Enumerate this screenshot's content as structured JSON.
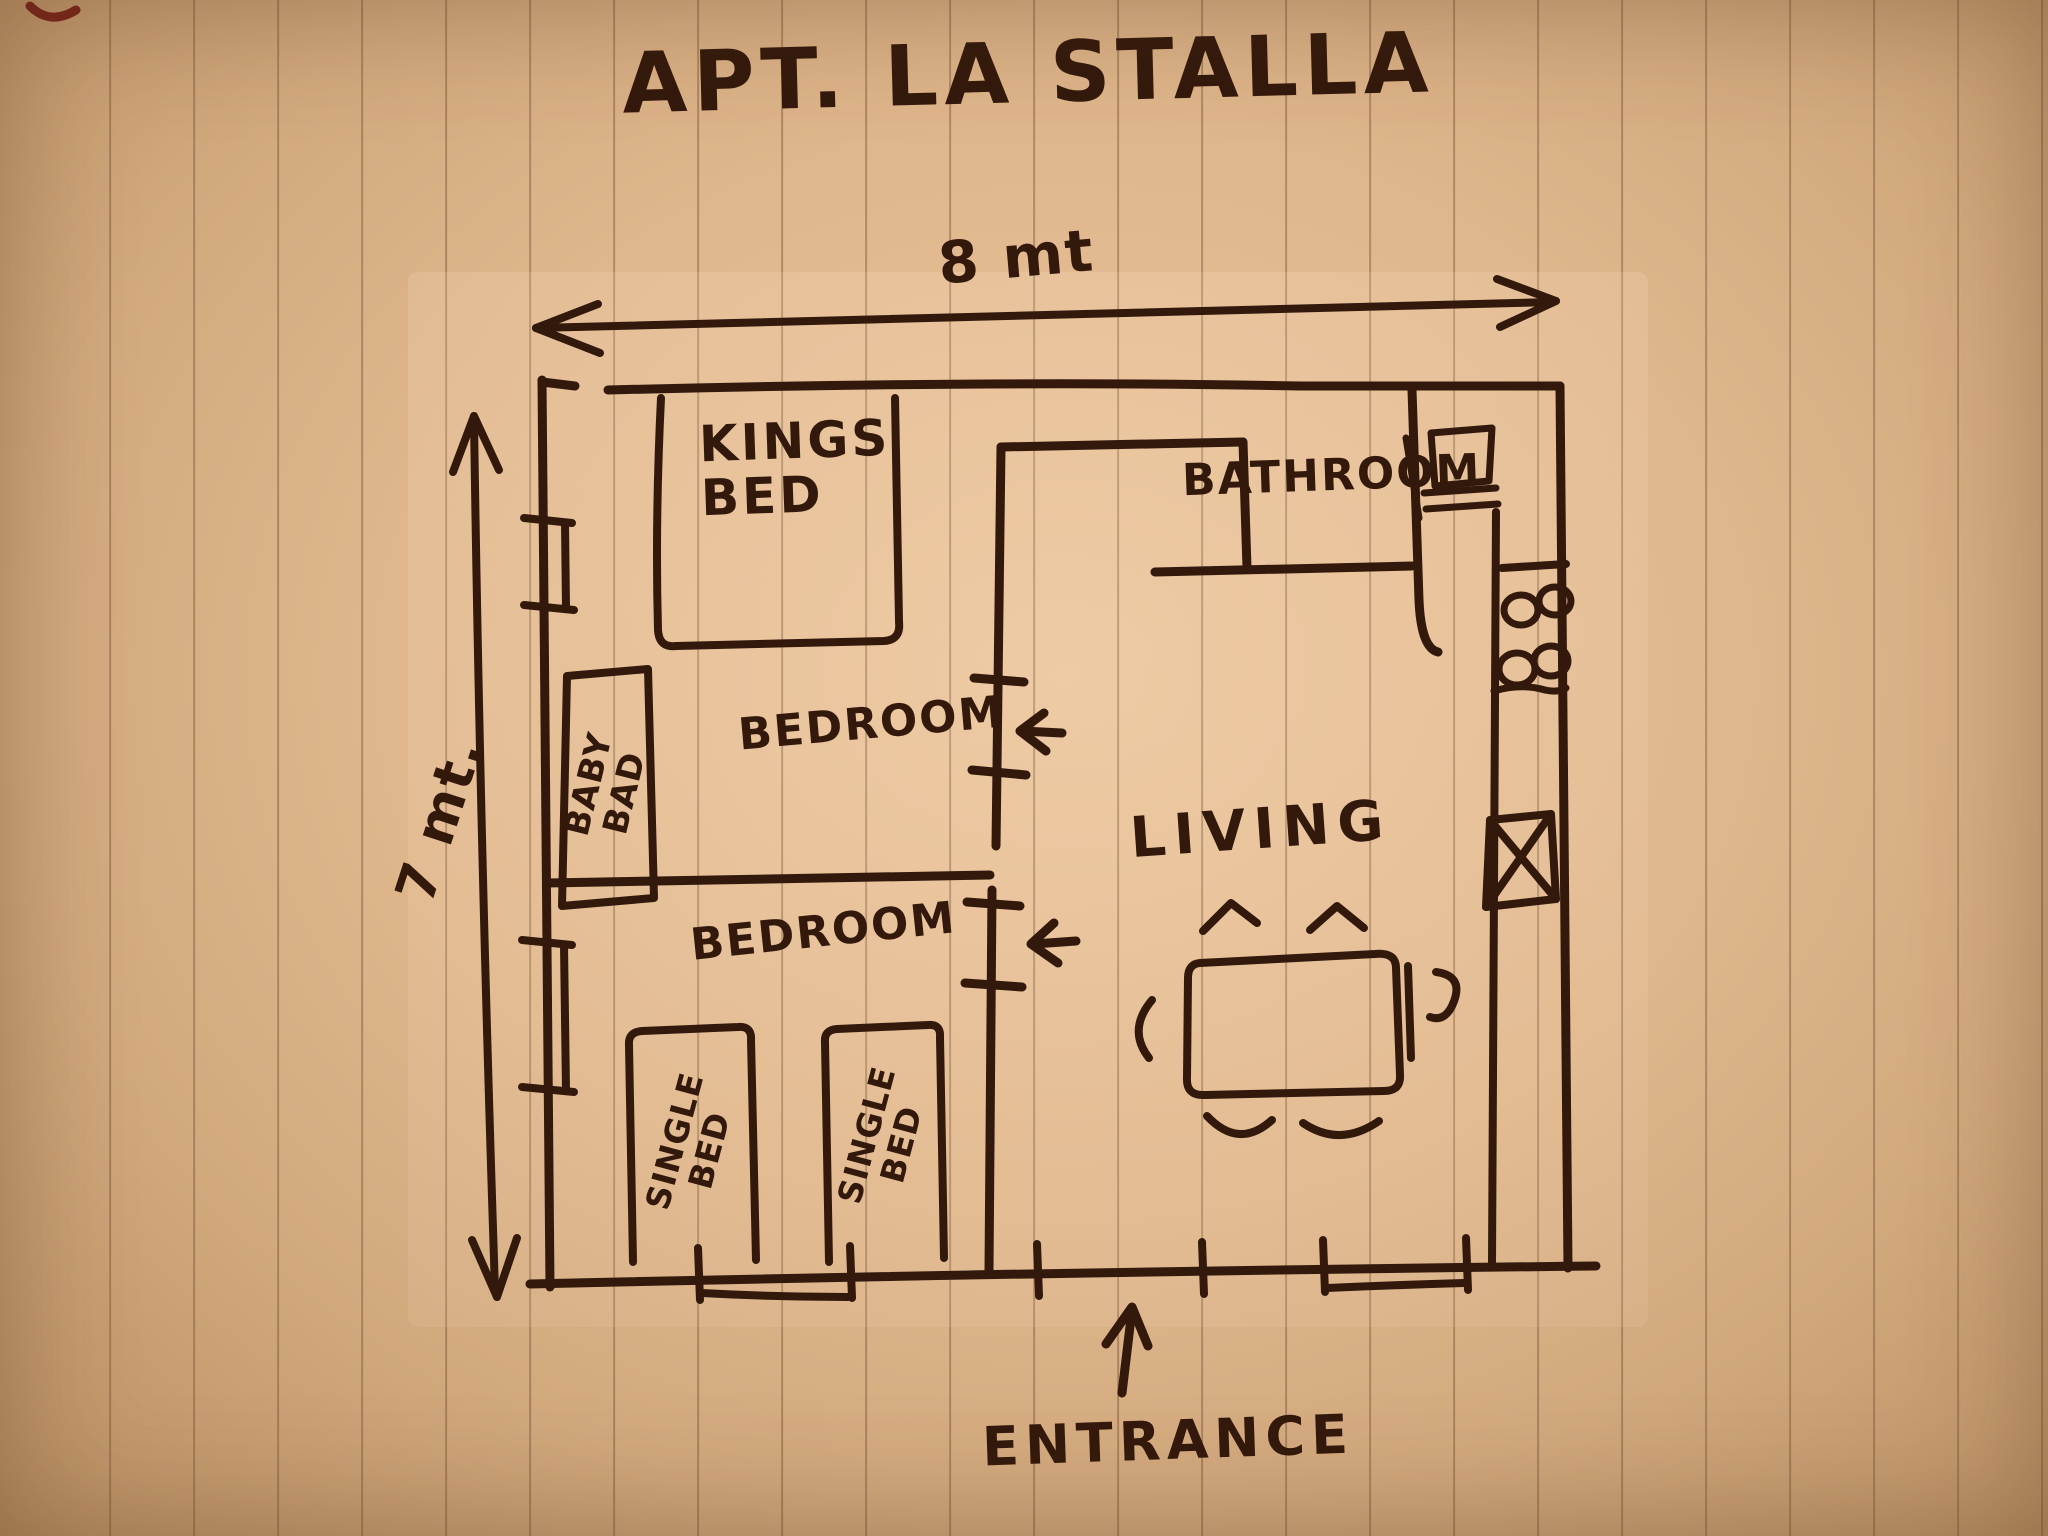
{
  "page": {
    "title": "APT. LA STALLA"
  },
  "dimensions": {
    "width_label": "8 mt",
    "height_label": "7 mt."
  },
  "rooms": {
    "kings_bed": {
      "line1": "KINGS",
      "line2": "BED"
    },
    "bathroom": {
      "label": "BATHROOM"
    },
    "bedroom_upper": {
      "label": "BEDROOM"
    },
    "bedroom_lower": {
      "label": "BEDROOM"
    },
    "baby_bed": {
      "line1": "BABY",
      "line2": "BAD"
    },
    "living": {
      "label": "LIVING"
    },
    "single_bed_left": {
      "line1": "SINGLE",
      "line2": "BED"
    },
    "single_bed_right": {
      "line1": "SINGLE",
      "line2": "BED"
    }
  },
  "entrance": {
    "label": "ENTRANCE"
  },
  "icons": {
    "stove_burners": "four-hand-drawn-circles",
    "kitchen_sink": "square-with-x",
    "bathroom_sink": "small-rect-with-double-lines",
    "door_upper": "left-arrow-between-wall-ticks",
    "door_lower": "left-arrow-between-wall-ticks",
    "entrance_arrow": "up-arrow",
    "width_dimension": "double-headed-horizontal-arrow",
    "height_dimension": "double-headed-vertical-arrow"
  },
  "colors": {
    "ink": "#33190c",
    "paper": "#e0b68c",
    "paper_light": "#ecc69e",
    "paper_dark": "#b98e62",
    "ruling": "#7a5838",
    "corner_mark": "#7b241a"
  }
}
